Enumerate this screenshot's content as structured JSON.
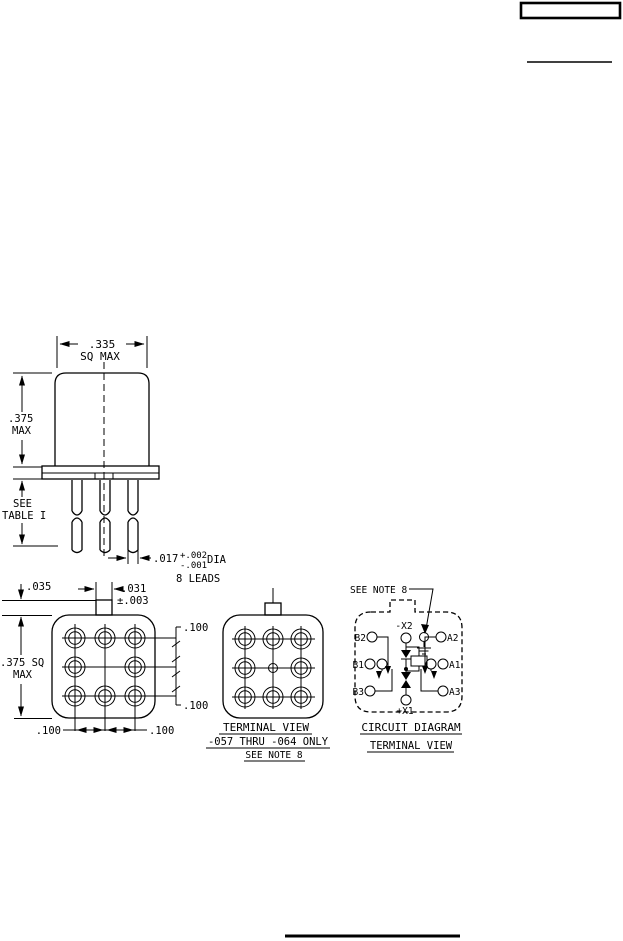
{
  "colors": {
    "ink": "#000000",
    "paper": "#ffffff"
  },
  "front_view": {
    "dim_width": ".335",
    "dim_width_qual": "SQ MAX",
    "dim_height": ".375",
    "dim_height_qual": "MAX",
    "lead_len_note1": "SEE",
    "lead_len_note2": "TABLE I",
    "lead_dia": ".017",
    "lead_dia_plus": "+.002",
    "lead_dia_minus": "-.001",
    "lead_dia_label": "DIA",
    "lead_count": "8 LEADS"
  },
  "bottom_view": {
    "tab_height": ".035",
    "tab_width": ".031",
    "tab_width_tol": "±.003",
    "body_size": ".375 SQ",
    "body_size_qual": "MAX",
    "pitch_right_top": ".100",
    "pitch_right_bottom": ".100",
    "pitch_bottom_left": ".100",
    "pitch_bottom_right": ".100"
  },
  "terminal_view": {
    "caption1": "TERMINAL VIEW",
    "caption2": "-057 THRU -064 ONLY",
    "caption3": "SEE NOTE 8"
  },
  "circuit_view": {
    "note": "SEE NOTE 8",
    "coil_neg": "-X2",
    "coil_pos": "+X1",
    "b2": "B2",
    "b1": "B1",
    "b3": "B3",
    "a2": "A2",
    "a1": "A1",
    "a3": "A3",
    "caption1": "CIRCUIT DIAGRAM",
    "caption2": "TERMINAL VIEW"
  }
}
